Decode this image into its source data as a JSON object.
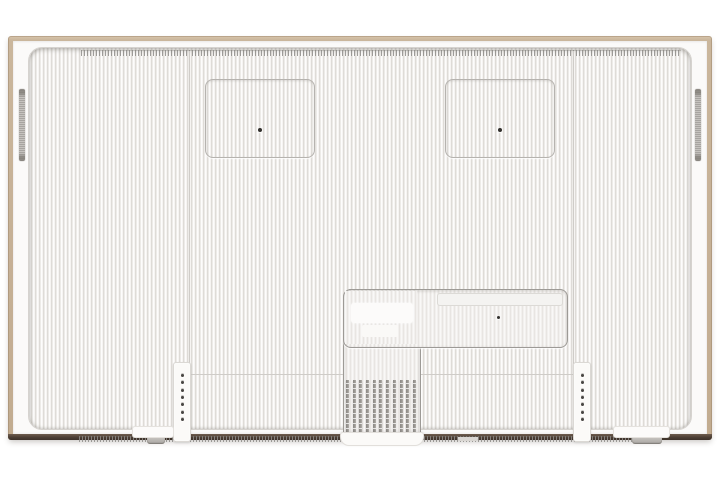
{
  "meta": {
    "description": "Rear view of a wall-mountable flat-screen TV with a light wood picture frame, ribbed back cover, two VESA mount recesses, side speaker grilles, lower I/O recess with blank labels, cable-guide fins and bracket rails"
  },
  "colors": {
    "background": "#ffffff",
    "frame_wood": "#cab69c",
    "frame_bottom": "#4a3d33",
    "bezel": "#fbfaf9",
    "panel_base": "#f4f2f0",
    "seam": "#cfccc8",
    "recess_border": "#9d9a96",
    "recess_fill": "#f2f0ee",
    "grille": "#b4b1ae",
    "fin_dark": "#95928e",
    "hole": "#33312e",
    "vent": "#8f8d8a"
  },
  "tv": {
    "mount_recesses": {
      "count": 2,
      "screw_holes_each": 1
    },
    "speaker_grilles": {
      "count": 2
    },
    "screw_strips": {
      "count": 2,
      "holes_per_strip": 7
    },
    "heat_fins": {
      "count": 11
    },
    "io_recess": {
      "blank_labels": 2,
      "screw_holes": 1,
      "tray": 1
    },
    "vent_strips": {
      "count": 2
    },
    "feet": {
      "count": 2
    }
  }
}
